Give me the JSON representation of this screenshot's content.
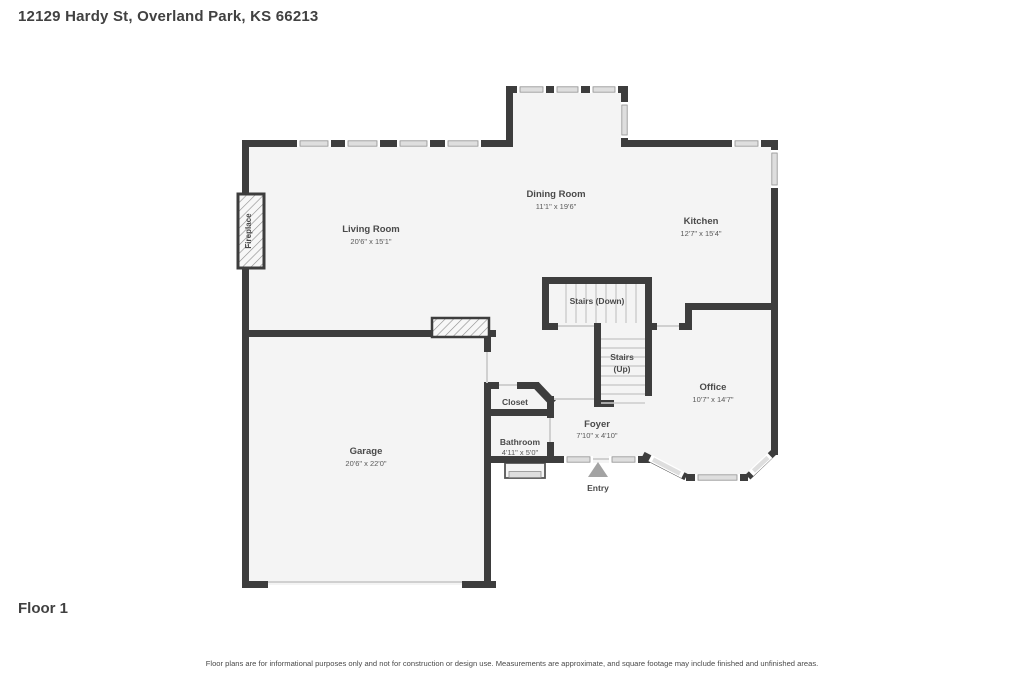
{
  "header": {
    "address": "12129 Hardy St, Overland Park, KS 66213"
  },
  "floor_label": "Floor 1",
  "disclaimer": "Floor plans are for informational purposes only and not for construction or design use. Measurements are approximate, and square footage may include finished and unfinished areas.",
  "colors": {
    "wall": "#3d3d3d",
    "interior": "#f4f4f4",
    "window": "#dedede",
    "tread": "#cccccc",
    "entry_arrow": "#a3a3a3"
  },
  "rooms": {
    "living_room": {
      "name": "Living Room",
      "dims": "20'6\" x 15'1\""
    },
    "dining_room": {
      "name": "Dining Room",
      "dims": "11'1\" x 19'6\""
    },
    "kitchen": {
      "name": "Kitchen",
      "dims": "12'7\" x 15'4\""
    },
    "office": {
      "name": "Office",
      "dims": "10'7\" x 14'7\""
    },
    "garage": {
      "name": "Garage",
      "dims": "20'6\" x 22'0\""
    },
    "foyer": {
      "name": "Foyer",
      "dims": "7'10\" x 4'10\""
    },
    "bathroom": {
      "name": "Bathroom",
      "dims": "4'11\" x 5'0\""
    },
    "closet": {
      "name": "Closet"
    },
    "stairs_down": {
      "name": "Stairs (Down)"
    },
    "stairs_up": {
      "line1": "Stairs",
      "line2": "(Up)"
    },
    "entry": {
      "name": "Entry"
    },
    "fireplace": {
      "name": "Fireplace"
    }
  }
}
